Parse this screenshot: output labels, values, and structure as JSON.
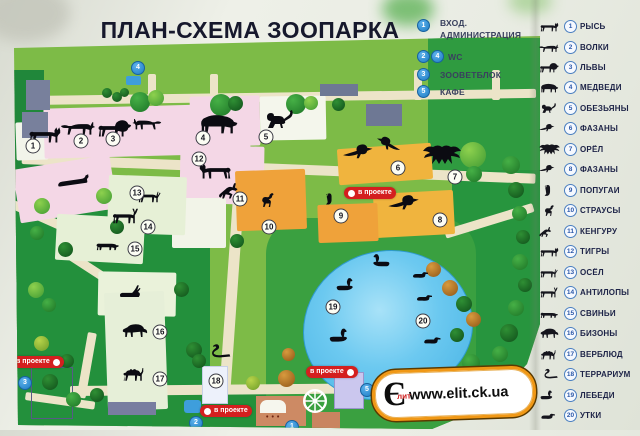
{
  "title": "ПЛАН-СХЕМА ЗООПАРКА",
  "facilities_legend": {
    "items": [
      {
        "num": "1",
        "line1": "ВХОД.",
        "line2": "АДМИНИСТРАЦИЯ"
      },
      {
        "num": "2",
        "num2": "4",
        "label": "WC"
      },
      {
        "num": "3",
        "label": "ЗООВЕТБЛОК"
      },
      {
        "num": "5",
        "label": "КАФЕ"
      }
    ]
  },
  "animal_legend": {
    "items": [
      {
        "number": "1",
        "label": "РЫСЬ",
        "icon": "lynx-icon"
      },
      {
        "number": "2",
        "label": "ВОЛКИ",
        "icon": "wolf-icon"
      },
      {
        "number": "3",
        "label": "ЛЬВЫ",
        "icon": "lion-icon"
      },
      {
        "number": "4",
        "label": "МЕДВЕДИ",
        "icon": "bear-icon"
      },
      {
        "number": "5",
        "label": "ОБЕЗЬЯНЫ",
        "icon": "monkey-icon"
      },
      {
        "number": "6",
        "label": "ФАЗАНЫ",
        "icon": "pheasant-icon"
      },
      {
        "number": "7",
        "label": "ОРЁЛ",
        "icon": "eagle-icon"
      },
      {
        "number": "8",
        "label": "ФАЗАНЫ",
        "icon": "pheasant-icon"
      },
      {
        "number": "9",
        "label": "ПОПУГАИ",
        "icon": "parrot-icon"
      },
      {
        "number": "10",
        "label": "СТРАУСЫ",
        "icon": "ostrich-icon"
      },
      {
        "number": "11",
        "label": "КЕНГУРУ",
        "icon": "kangaroo-icon"
      },
      {
        "number": "12",
        "label": "ТИГРЫ",
        "icon": "tiger-icon"
      },
      {
        "number": "13",
        "label": "ОСЁЛ",
        "icon": "donkey-icon"
      },
      {
        "number": "14",
        "label": "АНТИЛОПЫ",
        "icon": "antelope-icon"
      },
      {
        "number": "15",
        "label": "СВИНЬИ",
        "icon": "pig-icon"
      },
      {
        "number": "16",
        "label": "БИЗОНЫ",
        "icon": "bison-icon"
      },
      {
        "number": "17",
        "label": "ВЕРБЛЮД",
        "icon": "camel-icon"
      },
      {
        "number": "18",
        "label": "ТЕРРАРИУМ",
        "icon": "snake-icon"
      },
      {
        "number": "19",
        "label": "ЛЕБЕДИ",
        "icon": "swan-icon"
      },
      {
        "number": "20",
        "label": "УТКИ",
        "icon": "duck-icon"
      }
    ]
  },
  "map": {
    "project_label": "в проекте",
    "facility_markers": {
      "entrance": "1",
      "wc_south": "2",
      "zoovet": "3",
      "wc_north": "4",
      "cafe": "5"
    }
  },
  "watermark": {
    "url": "www.elit.ck.ua",
    "logo_main": "Є",
    "logo_sub": "лит"
  },
  "colors": {
    "field_green": "#7dbb47",
    "dark_green": "#23903c",
    "path_cream": "#ece4c8",
    "pond_blue": "#5fc3ee",
    "enclosure_pink": "#f4d7e6",
    "enclosure_yellow": "#f0b43e",
    "enclosure_orange": "#efa23a",
    "project_red": "#d41f1f",
    "marker_blue": "#2e8fd8",
    "watermark_orange": "#f09816",
    "title_ink": "#16182c"
  }
}
